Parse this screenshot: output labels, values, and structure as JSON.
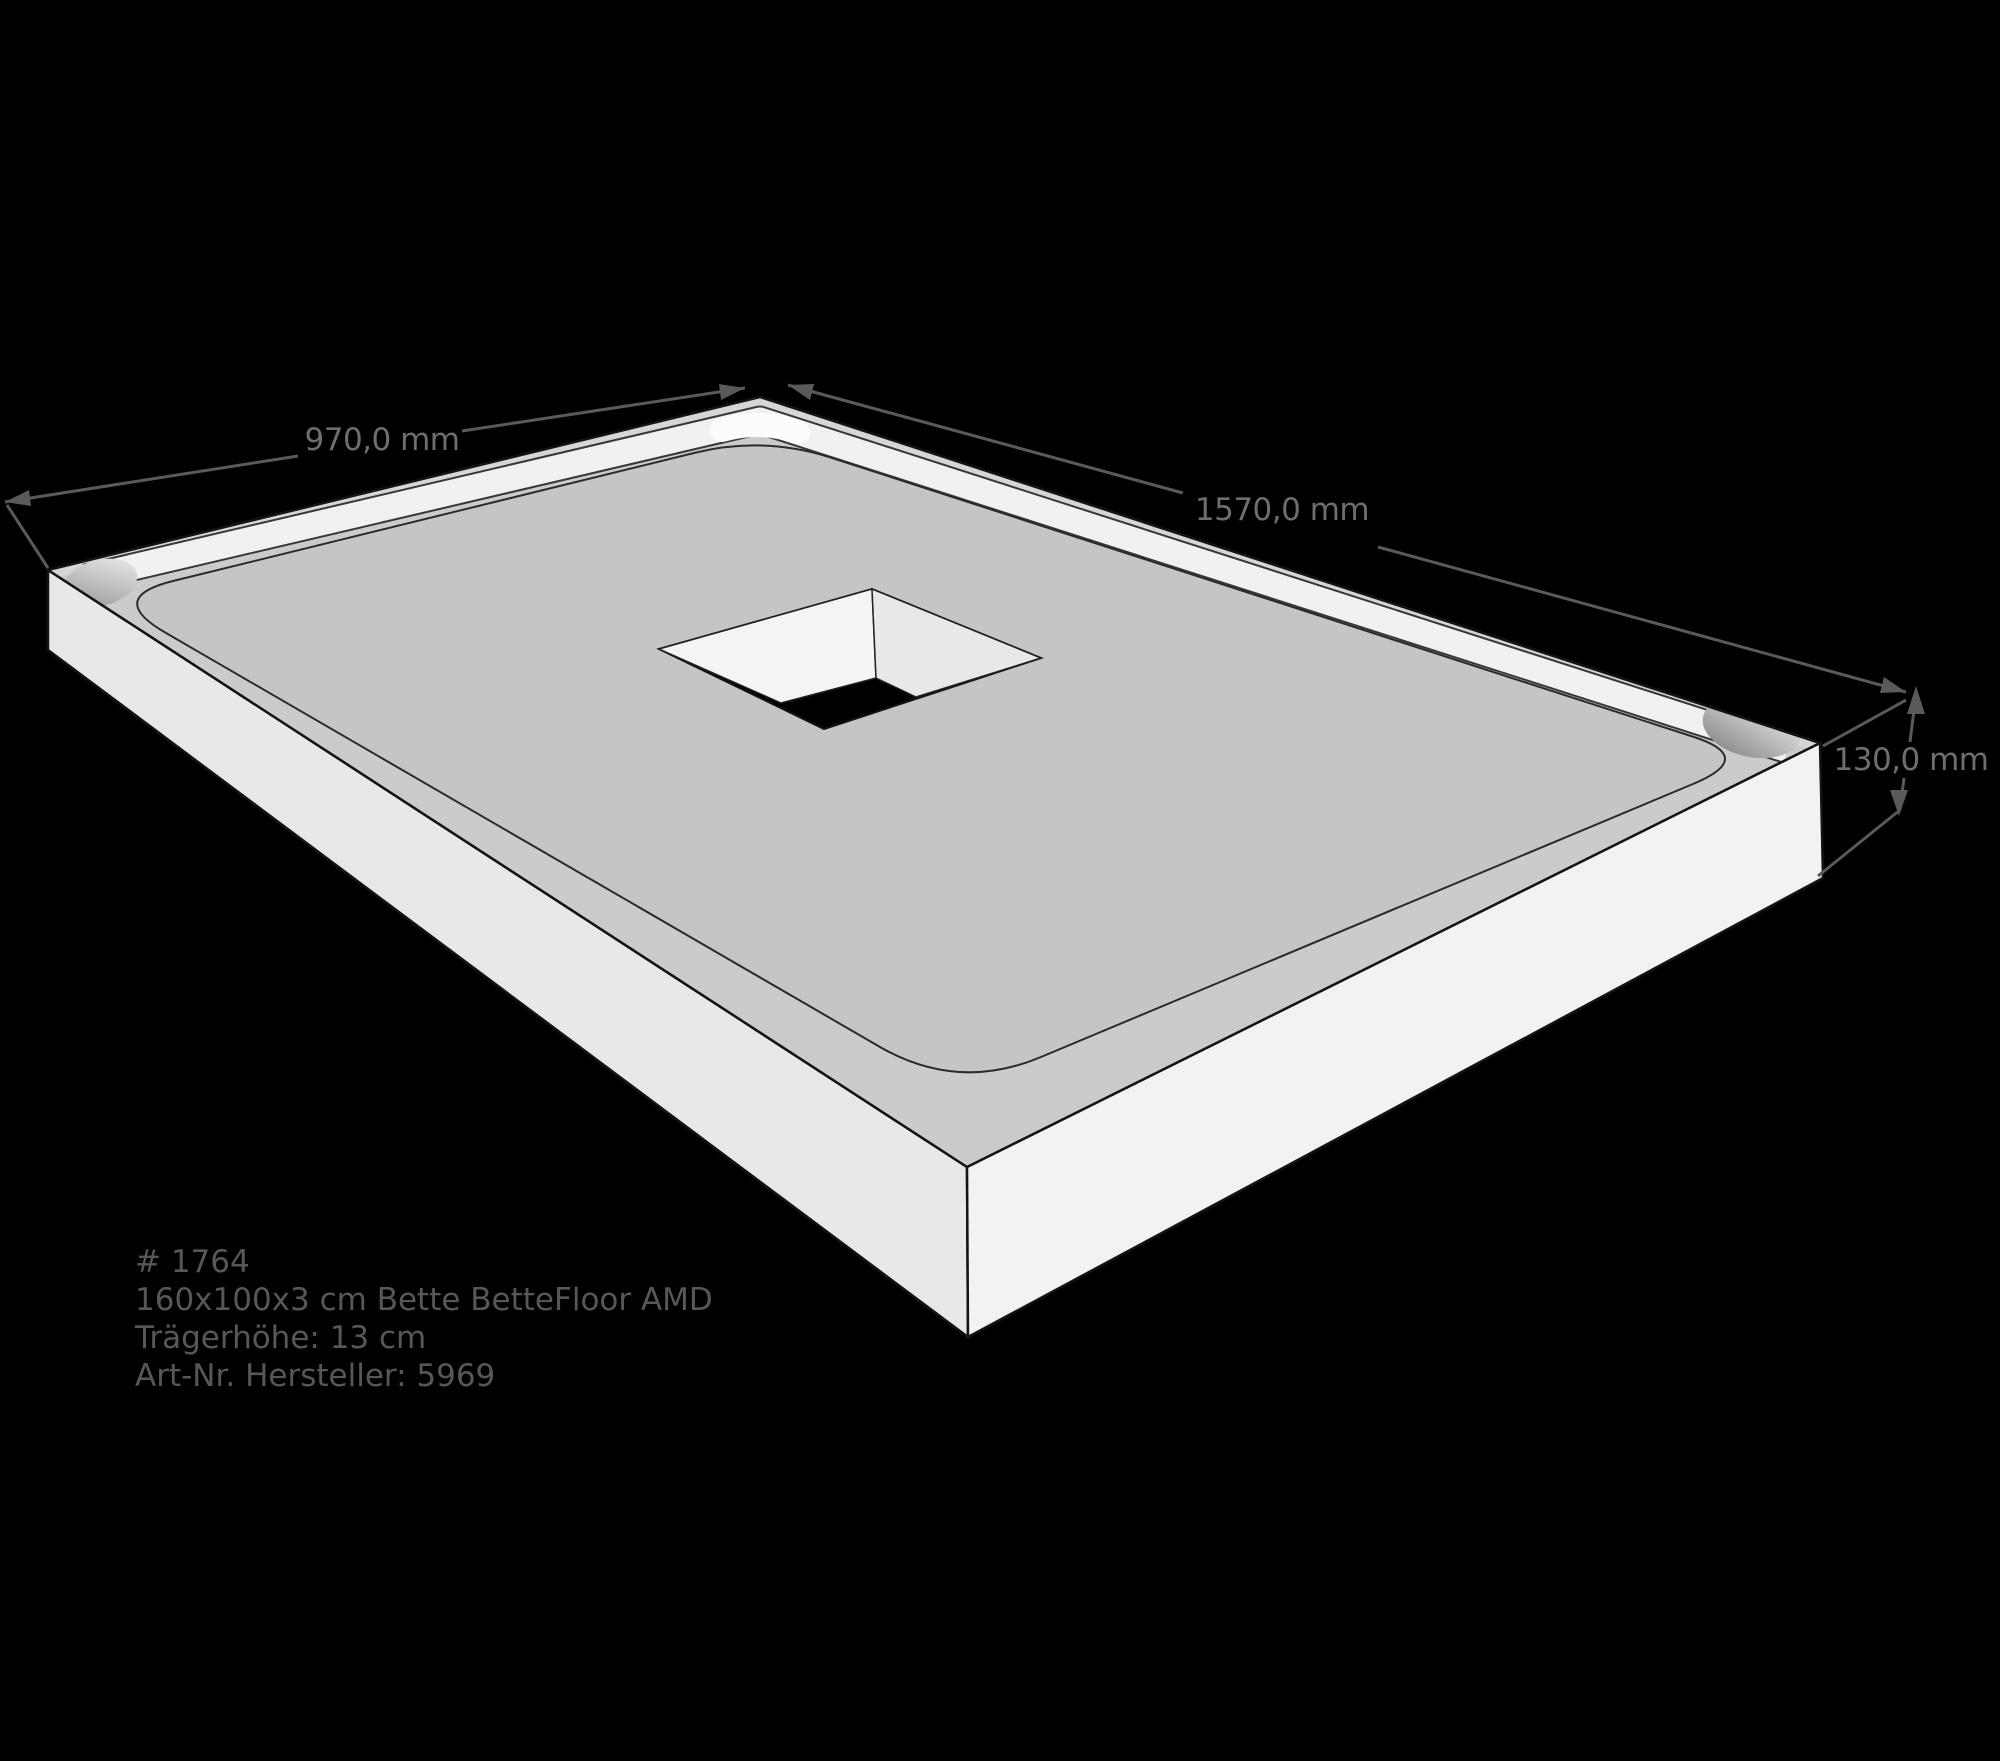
{
  "illustration": {
    "kind": "3D technical drawing of a shower tray support (foam carrier) with central square drain cutout",
    "background_color": "#000000",
    "body_colors": {
      "top_rim": "#cbcbcb",
      "inner_floor": "#c5c5c5",
      "sloped_band": "#f1f1f1",
      "front_left_face": "#e8e8e8",
      "front_right_face": "#f2f2f2",
      "drain_hole": "#000000",
      "outline": "#141414",
      "dimension_lines": "#5a5a5a"
    }
  },
  "dimensions": {
    "width_label": "970,0 mm",
    "length_label": "1570,0 mm",
    "height_label": "130,0 mm"
  },
  "product": {
    "line1": "# 1764",
    "line2": "160x100x3 cm Bette BetteFloor AMD",
    "line3": "Trägerhöhe: 13 cm",
    "line4": "Art-Nr. Hersteller: 5969"
  }
}
